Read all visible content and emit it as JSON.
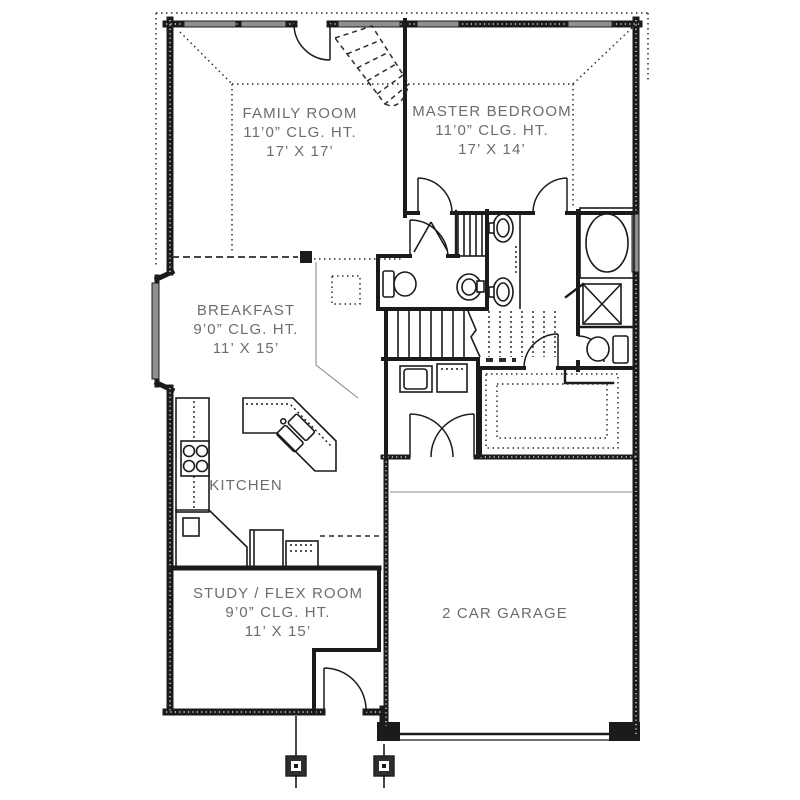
{
  "plan": {
    "rooms": {
      "family": {
        "name": "FAMILY ROOM",
        "ceiling": "11’0” CLG. HT.",
        "dims": "17’ X 17’"
      },
      "master": {
        "name": "MASTER BEDROOM",
        "ceiling": "11’0” CLG. HT.",
        "dims": "17’ X 14’"
      },
      "breakfast": {
        "name": "BREAKFAST",
        "ceiling": "9’0” CLG. HT.",
        "dims": "11’ X 15’"
      },
      "kitchen": {
        "name": "KITCHEN"
      },
      "study": {
        "name": "STUDY / FLEX ROOM",
        "ceiling": "9’0” CLG. HT.",
        "dims": "11’ X 15’"
      },
      "garage": {
        "name": "2 CAR GARAGE"
      }
    },
    "colors": {
      "wall": "#1b1b1b",
      "window": "#8f8f8f",
      "text": "#6d6d6d",
      "background": "#ffffff"
    }
  }
}
